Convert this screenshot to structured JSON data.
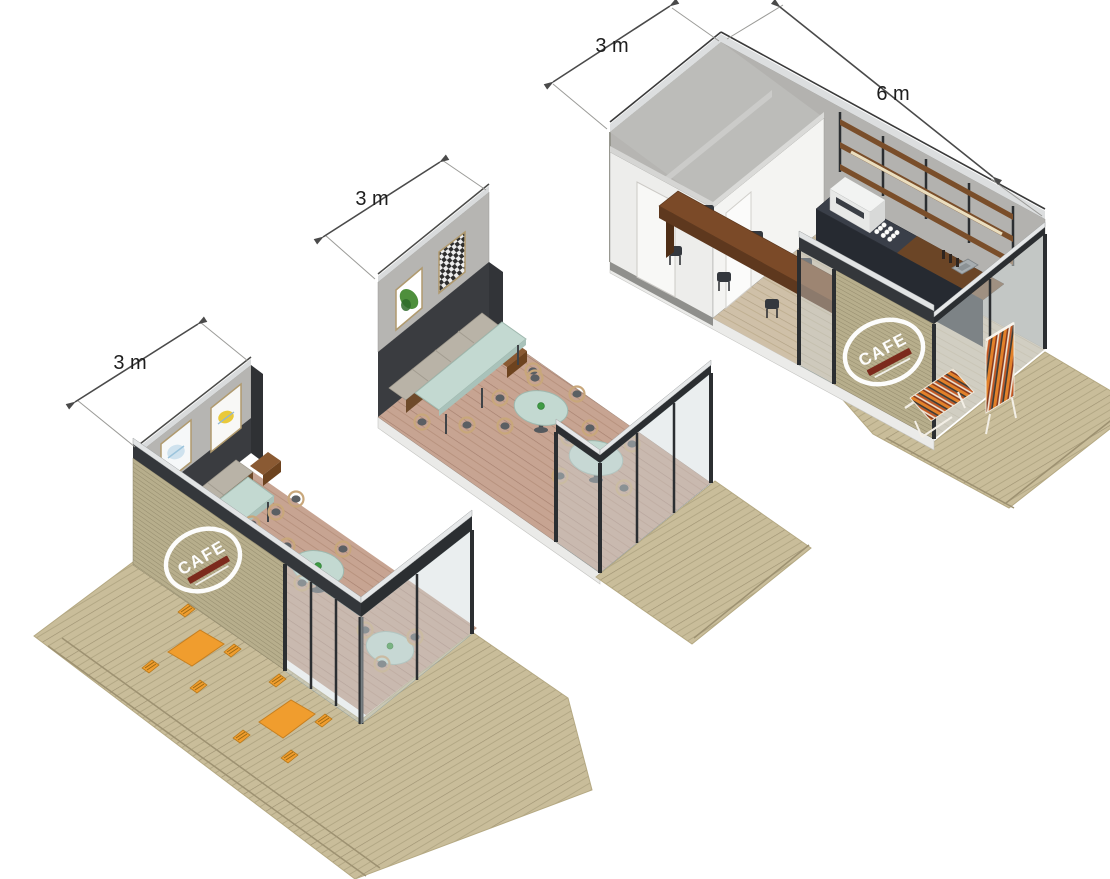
{
  "units": [
    {
      "name": "small cafe unit",
      "width_label": "3 m",
      "logo_text": "CAFE"
    },
    {
      "name": "medium cafe unit",
      "width_label": "3 m"
    },
    {
      "name": "large cafe unit",
      "width_label": "3 m",
      "length_label": "6 m",
      "logo_text": "CAFE"
    }
  ],
  "colors": {
    "background": "#ffffff",
    "dimension_line": "#4a4a4a",
    "dimension_text": "#1d1d1d",
    "deck_wood": "#c9bd9a",
    "slat_wall": "#b7ae8c",
    "concrete_wall": "#b6b5b2",
    "dark_wall_band": "#3a3c40",
    "white_wall": "#f2f2f0",
    "interior_floor": "#c7a492",
    "mint_table": "#c3d9d1",
    "chair_wood": "#c8a77b",
    "bench_cushion": "#b9b3a7",
    "orange_furniture": "#f09d2e",
    "communal_table": "#7b4a28",
    "counter_dark": "#262a31",
    "frame_dark": "#2b2e31",
    "frame_cap": "#e6e8e9",
    "glass": "#ccd7d8",
    "logo_white": "#fdfdfc",
    "logo_accent_red": "#7c2a1c",
    "lounger_stripe_orange": "#e2812a",
    "lounger_stripe_red": "#8a3a1e",
    "cup_green": "#3f9b45"
  }
}
